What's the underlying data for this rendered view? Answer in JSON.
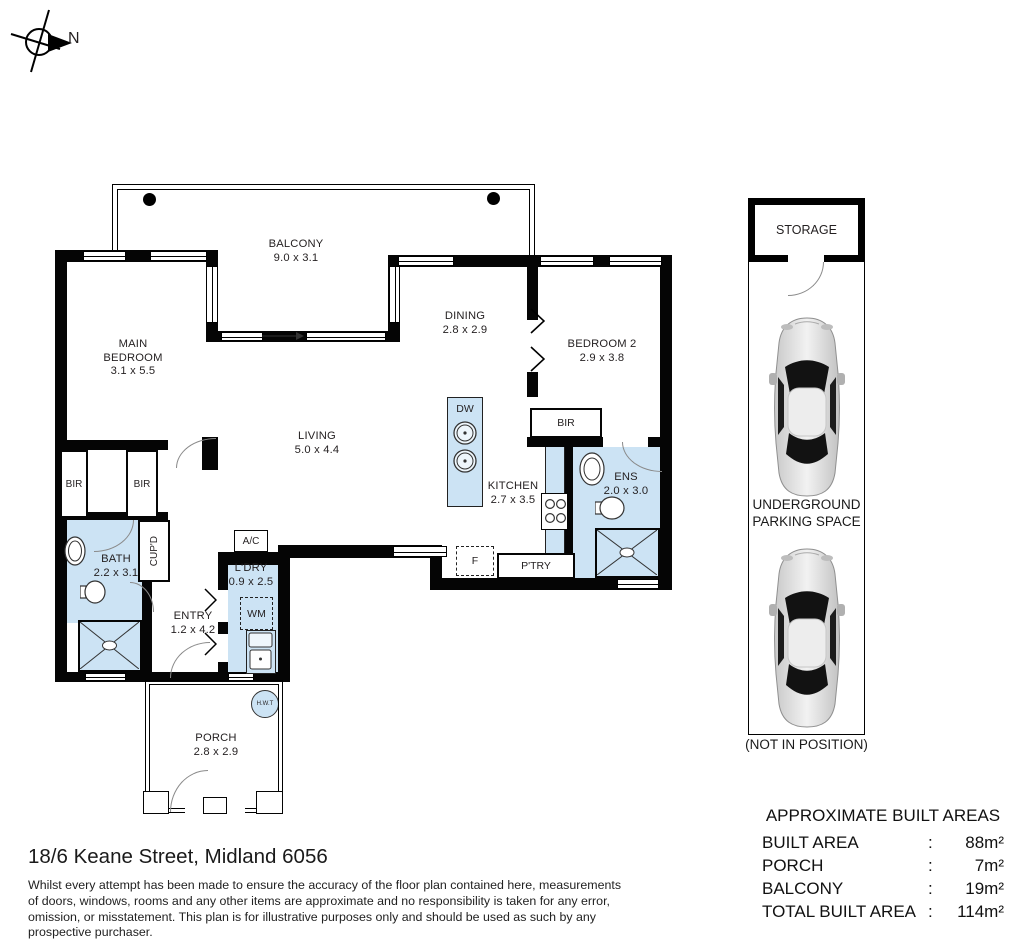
{
  "compass": {
    "label": "N"
  },
  "plan": {
    "rooms": {
      "balcony": {
        "name": "BALCONY",
        "dims": "9.0 x 3.1"
      },
      "main_bedroom": {
        "name": "MAIN BEDROOM",
        "dims": "3.1 x 5.5"
      },
      "living": {
        "name": "LIVING",
        "dims": "5.0 x 4.4"
      },
      "dining": {
        "name": "DINING",
        "dims": "2.8 x 2.9"
      },
      "bedroom2": {
        "name": "BEDROOM 2",
        "dims": "2.9 x 3.8"
      },
      "kitchen": {
        "name": "KITCHEN",
        "dims": "2.7 x 3.5"
      },
      "ens": {
        "name": "ENS",
        "dims": "2.0 x 3.0"
      },
      "bath": {
        "name": "BATH",
        "dims": "2.2 x 3.1"
      },
      "entry": {
        "name": "ENTRY",
        "dims": "1.2 x 4.2"
      },
      "ldry": {
        "name": "L'DRY",
        "dims": "0.9 x 2.5"
      },
      "porch": {
        "name": "PORCH",
        "dims": "2.8 x 2.9"
      }
    },
    "fixtures": {
      "dw": "DW",
      "bir_bed2": "BIR",
      "bir_1": "BIR",
      "bir_2": "BIR",
      "cupd": "CUP'D",
      "ac": "A/C",
      "wm": "WM",
      "fridge": "F",
      "pantry": "P'TRY",
      "hwt": "H.W.T"
    }
  },
  "parking": {
    "storage_label": "STORAGE",
    "caption_line1": "UNDERGROUND",
    "caption_line2": "PARKING SPACE",
    "note": "(NOT IN POSITION)"
  },
  "areas": {
    "title": "APPROXIMATE BUILT AREAS",
    "rows": [
      {
        "label": "BUILT AREA",
        "sep": ":",
        "value": "88m²"
      },
      {
        "label": "PORCH",
        "sep": ":",
        "value": "7m²"
      },
      {
        "label": "BALCONY",
        "sep": ":",
        "value": "19m²"
      },
      {
        "label": "TOTAL BUILT AREA",
        "sep": ":",
        "value": "114m²"
      }
    ]
  },
  "footer": {
    "address": "18/6 Keane Street, Midland 6056",
    "disclaimer": "Whilst every attempt has been made to ensure the accuracy of the floor plan contained here, measurements of doors, windows, rooms and any other items are approximate and no responsibility is taken for any error, omission, or misstatement. This plan is for illustrative purposes only and should be used as such by any prospective purchaser."
  },
  "colors": {
    "room_fill": "#cce3f4",
    "wall": "#050505"
  }
}
